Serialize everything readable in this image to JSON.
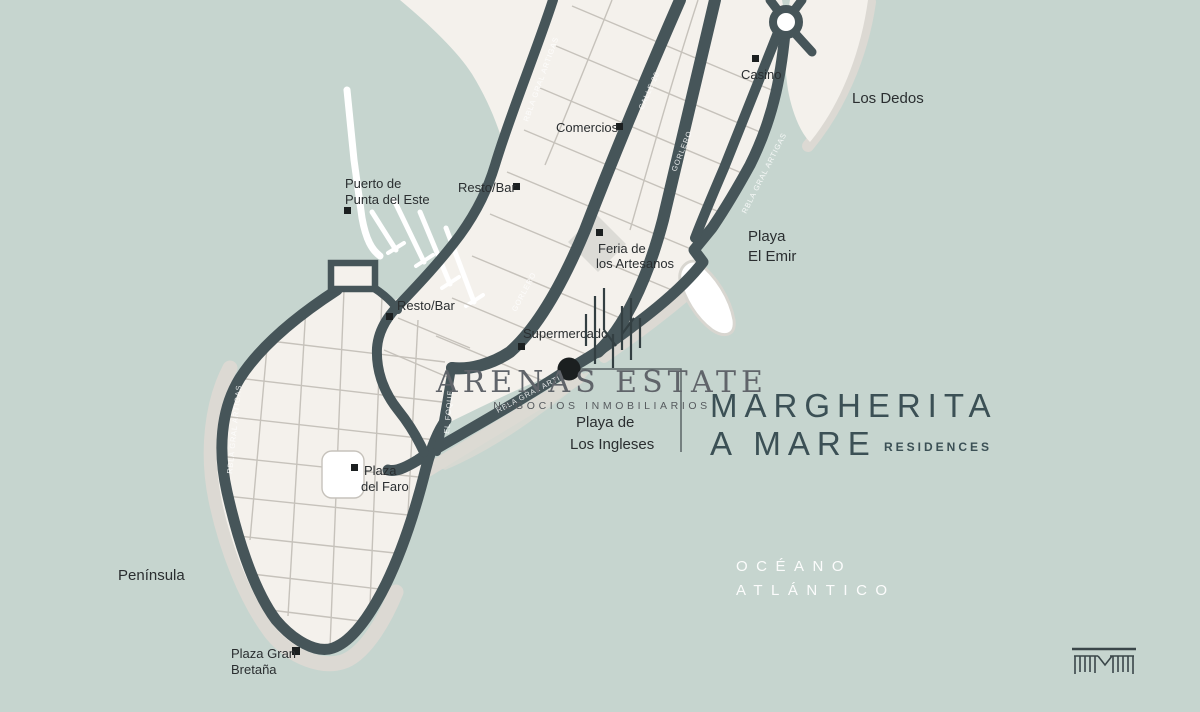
{
  "colors": {
    "water": "#c6d5cf",
    "land": "#f4f1ec",
    "beach": "#dcd9d3",
    "road": "#465559",
    "grid_line": "#c6c2bb",
    "marker": "#1b1f20",
    "label_text": "#2a2e30",
    "brand_dark": "#3b5055",
    "logo_gray": "#60646a",
    "white": "#ffffff"
  },
  "brand": {
    "arenas": "ARENAS ESTATE",
    "arenas_sub": "NEGOCIOS INMOBILIARIOS",
    "project_l1": "MARGHERITA",
    "project_l2": "A MARE",
    "residences": "RESIDENCES"
  },
  "ocean": {
    "l1": "OCÉANO",
    "l2": "ATLÁNTICO"
  },
  "areas": {
    "los_dedos": "Los Dedos",
    "peninsula": "Península",
    "emir_l1": "Playa",
    "emir_l2": "El Emir",
    "ingleses_l1": "Playa de",
    "ingleses_l2": "Los Ingleses"
  },
  "pois": {
    "casino": "Casino",
    "comercios": "Comercios",
    "resto_bar": "Resto/Bar",
    "puerto_l1": "Puerto de",
    "puerto_l2": "Punta del Este",
    "feria_l1": "Feria de",
    "feria_l2": "los Artesanos",
    "supermercado": "Supermercado",
    "plaza_faro_l1": "Plaza",
    "plaza_faro_l2": "del Faro",
    "plaza_gb_l1": "Plaza Gran",
    "plaza_gb_l2": "Bretaña"
  },
  "streets": {
    "rbla": "RBLA GRAL ARTIGAS",
    "gorlero": "GORLERO",
    "calle20": "CALLE 20",
    "foque": "EL FOQUE"
  }
}
